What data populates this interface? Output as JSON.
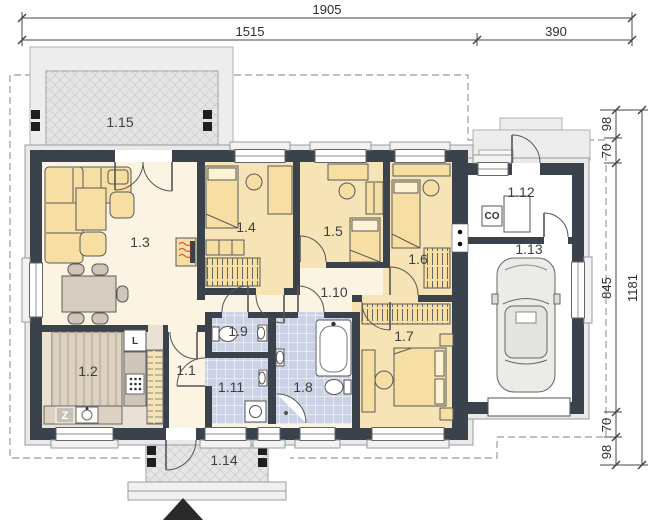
{
  "dimensions": {
    "top_total": "1905",
    "top_left": "1515",
    "top_right": "390",
    "right_seg1": "98",
    "right_seg2": "70",
    "right_seg3": "845",
    "right_seg4": "70",
    "right_seg5": "98",
    "right_total": "1181"
  },
  "rooms": {
    "hall": "1.1",
    "kitchen": "1.2",
    "living": "1.3",
    "bedroom1": "1.4",
    "bedroom2": "1.5",
    "bedroom3": "1.6",
    "bedroom4": "1.7",
    "bathroom": "1.8",
    "wc": "1.9",
    "corridor": "1.10",
    "bathroom2": "1.11",
    "utility": "1.12",
    "garage": "1.13",
    "porch": "1.14",
    "terrace": "1.15"
  },
  "appliances": {
    "fridge": "L",
    "dishwasher": "Z",
    "boiler": "CO"
  },
  "colors": {
    "wall": "#3a424b",
    "floor_living": "#fbf4e2",
    "floor_bedroom": "#f6e4b6",
    "floor_bath": "#ccd2e6",
    "floor_kitchen": "#e8e1d4",
    "furniture": "#f7dfa4",
    "terrace": "#e6e6e6"
  }
}
